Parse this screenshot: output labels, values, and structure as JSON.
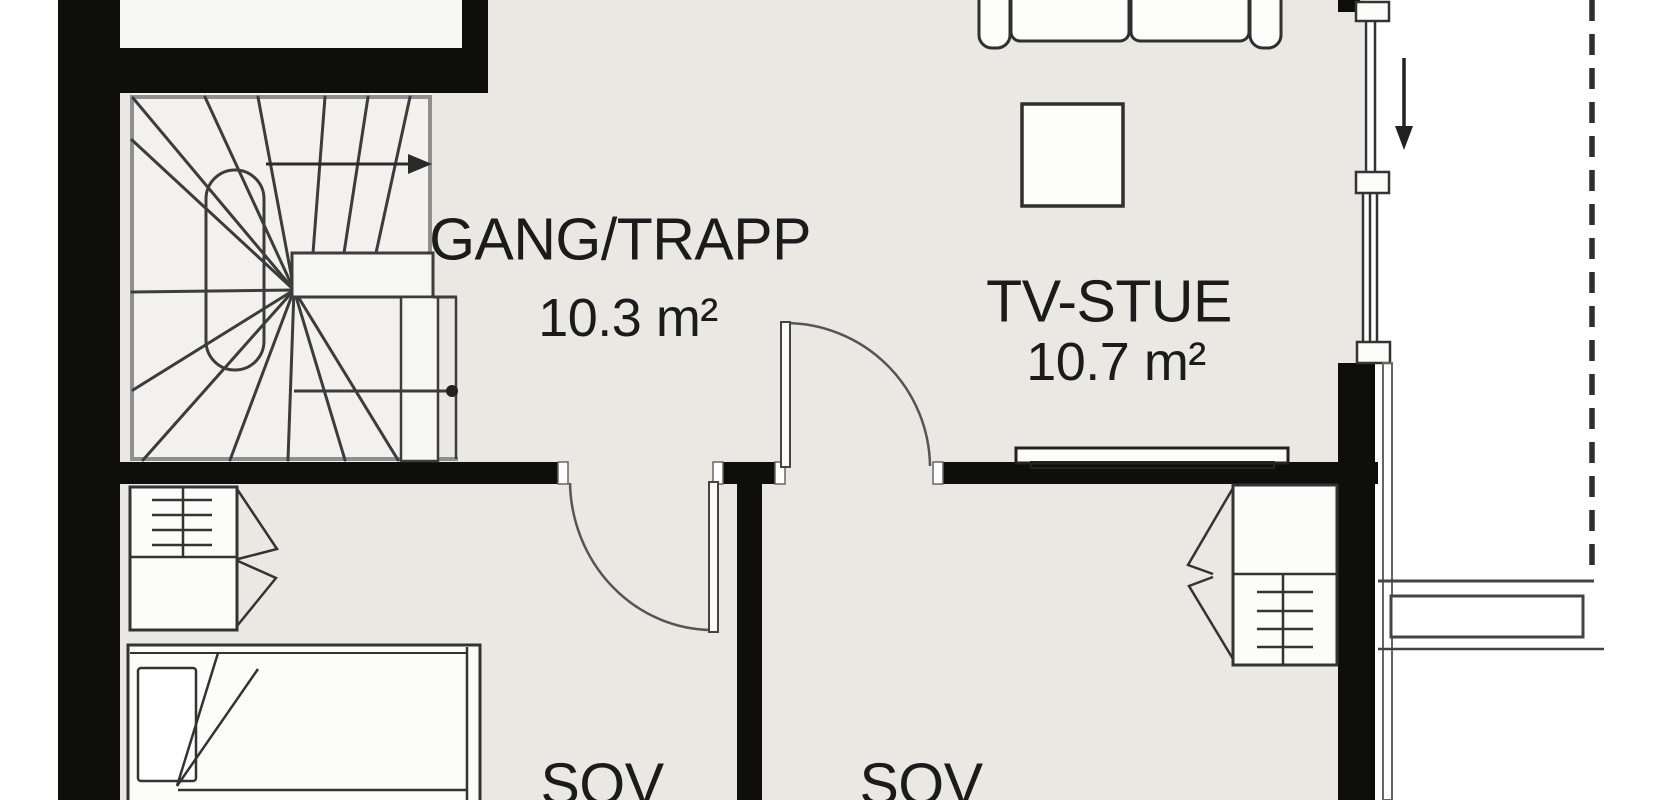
{
  "plan": {
    "type": "floor-plan",
    "rooms": {
      "gang": {
        "name": "GANG/TRAPP",
        "area": "10.3 m²"
      },
      "tv": {
        "name": "TV-STUE",
        "area": "10.7 m²"
      },
      "sov1": {
        "name": "SOV"
      },
      "sov2": {
        "name": "SOV"
      }
    },
    "symbols": {
      "stair_direction_arrow": "right",
      "entrance_direction_arrow": "down"
    },
    "colors": {
      "wall": "#0e0e0d",
      "floor": "#eae8e2",
      "stair_floor": "#f2f1ed",
      "furniture_fill": "#fcfcfa",
      "line": "#333333",
      "stair_enclosure": "#8f8f8f",
      "outside": "#ffffff"
    }
  }
}
